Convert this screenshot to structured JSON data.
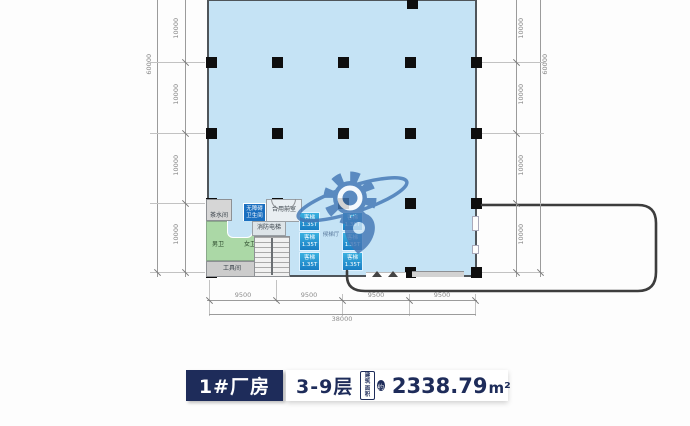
{
  "plan": {
    "rooms": {
      "tea_room": "茶水间",
      "accessible_toilet_line1": "无障碍",
      "accessible_toilet_line2": "卫生间",
      "shared_front_room": "合用前室",
      "mens_toilet": "男卫",
      "womens_toilet": "女卫",
      "fire_elevator": "消防电梯",
      "tool_room": "工具间",
      "elevator_lobby": "候梯厅"
    },
    "elevator": {
      "label": "客梯",
      "capacity": "1.35T"
    },
    "dimensions": {
      "left_total": "60000",
      "left_segments": [
        "10000",
        "10000",
        "10000",
        "10000"
      ],
      "right_total": "60000",
      "right_segments": [
        "10000",
        "10000",
        "10000",
        "10000"
      ],
      "bottom_segments": [
        "9500",
        "9500",
        "9500",
        "9500"
      ],
      "bottom_total": "38000"
    },
    "colors": {
      "floor_blue": "#c5e3f5",
      "toilet_green": "#abd8a6",
      "elevator_blue": "#1f8fd0",
      "navy": "#1e2c5a",
      "accessible_blue": "#1a6fc0"
    }
  },
  "footer": {
    "building_label": "1#厂房",
    "floors_label": "3-9层",
    "area_badge_line1": "建筑",
    "area_badge_line2": "面积",
    "area_badge_circle": "约",
    "area_number": "2338.79",
    "area_unit": "m²"
  }
}
